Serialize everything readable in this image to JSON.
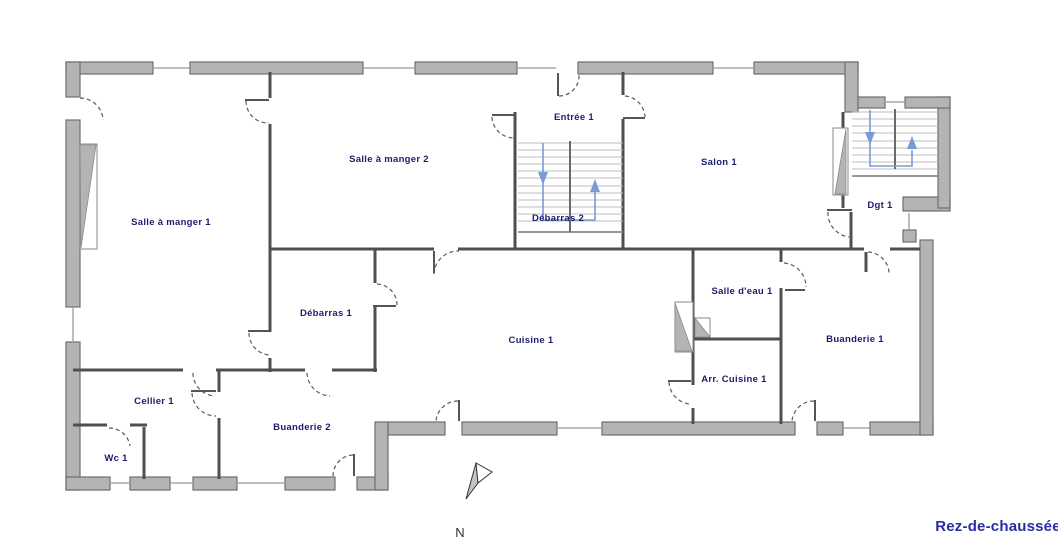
{
  "title": "Rez-de-chaussée",
  "compass": {
    "label": "N"
  },
  "rooms": {
    "salle_a_manger_1": {
      "label": "Salle à manger 1"
    },
    "salle_a_manger_2": {
      "label": "Salle à manger 2"
    },
    "entree_1": {
      "label": "Entrée 1"
    },
    "debarras_2": {
      "label": "Débarras 2"
    },
    "salon_1": {
      "label": "Salon 1"
    },
    "dgt_1": {
      "label": "Dgt 1"
    },
    "debarras_1": {
      "label": "Débarras 1"
    },
    "cuisine_1": {
      "label": "Cuisine 1"
    },
    "salle_deau_1": {
      "label": "Salle d'eau 1"
    },
    "buanderie_1": {
      "label": "Buanderie 1"
    },
    "arr_cuisine_1": {
      "label": "Arr. Cuisine 1"
    },
    "cellier_1": {
      "label": "Cellier 1"
    },
    "wc_1": {
      "label": "Wc 1"
    },
    "buanderie_2": {
      "label": "Buanderie 2"
    }
  },
  "stairs": [
    {
      "id": "staircase-entree",
      "arrows": [
        "down",
        "up"
      ]
    },
    {
      "id": "staircase-dgt",
      "arrows": [
        "down",
        "up"
      ]
    }
  ],
  "colors": {
    "wall_fill": "#b4b4b4",
    "wall_stroke": "#6e6e6e",
    "interior_wall": "#4f4f4f",
    "room_label": "#1d1d6e",
    "title_color": "#2b2ba6",
    "stair_blue": "#7a9bd4",
    "tread": "#bcbcbc",
    "window": "#a8a8a8"
  }
}
